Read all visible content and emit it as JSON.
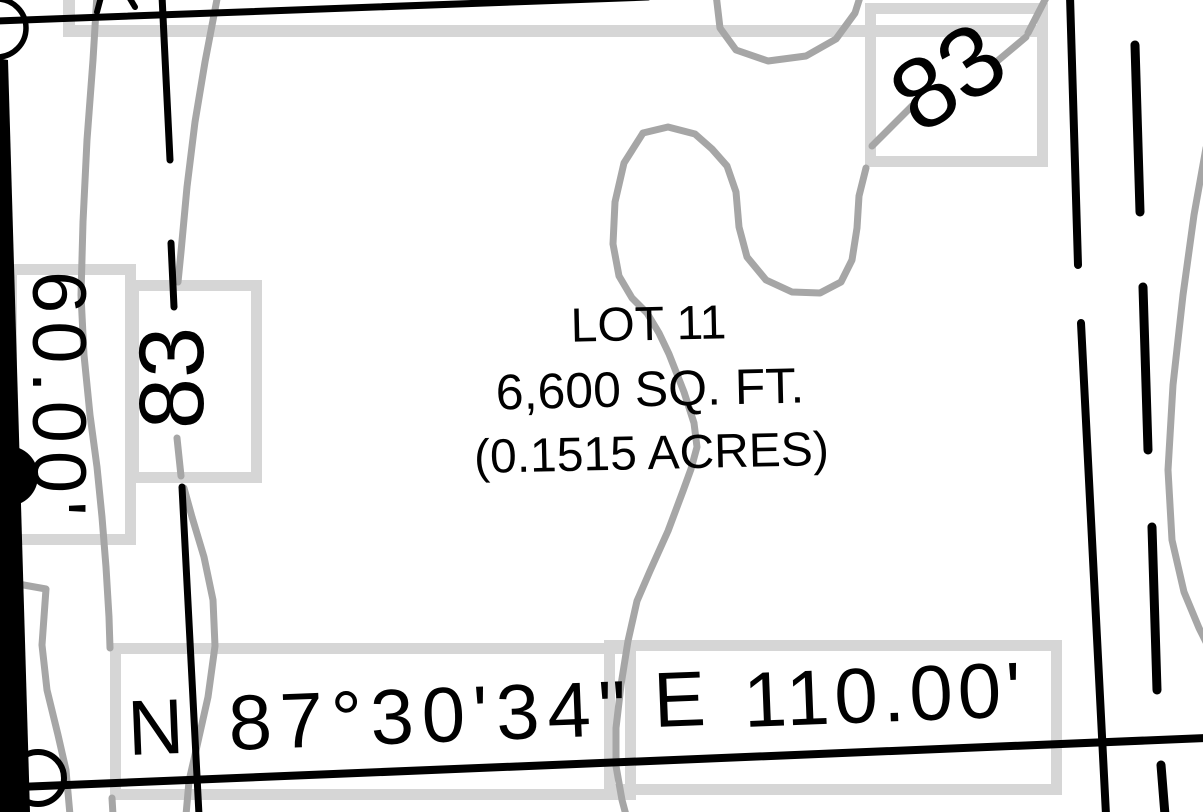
{
  "map": {
    "type": "plat-survey-map",
    "colors": {
      "contour_gray": "#a6a6a6",
      "label_box_gray": "#d6d6d6",
      "ink": "#000000",
      "background": "#ffffff"
    },
    "lot": {
      "name": "LOT 11",
      "area_sqft": "6,600 SQ. FT.",
      "area_acres": "(0.1515 ACRES)"
    },
    "south_boundary": {
      "direction_prefix": "N",
      "angle": "87°30'34\"",
      "direction_suffix": "E",
      "distance": "110.00'"
    },
    "west_boundary": {
      "distance": "60.00'"
    },
    "contour_labels": {
      "left_elevation": "83",
      "upper_right_elevation": "83"
    }
  }
}
